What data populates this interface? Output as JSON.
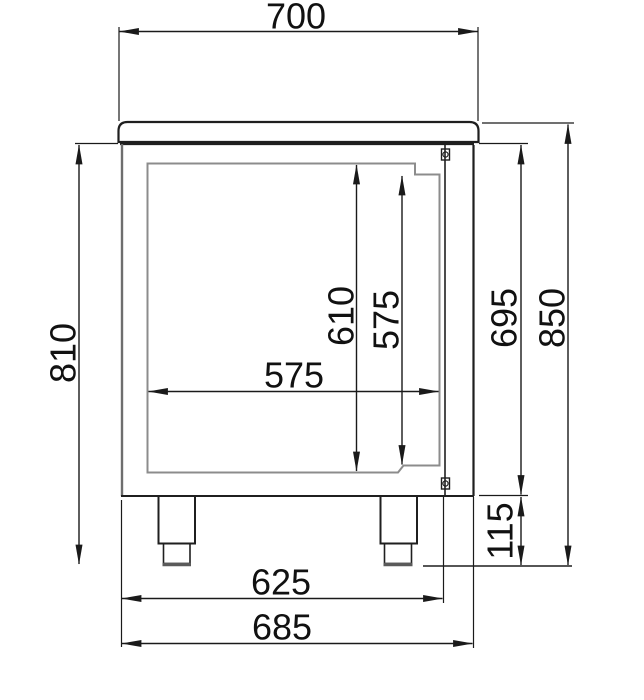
{
  "drawing": {
    "description": "Technical side-section drawing of a refrigerated counter cabinet with worktop, door and adjustable feet, annotated with dimensions",
    "colors": {
      "primary_line": "#1a1a1a",
      "secondary_line": "#8c8c8c",
      "background": "#ffffff"
    },
    "dimensions": {
      "countertop_depth": {
        "value": "700",
        "orientation": "horizontal",
        "position": "top"
      },
      "body_height": {
        "value": "810",
        "orientation": "vertical",
        "position": "left"
      },
      "interior_height": {
        "value": "610",
        "orientation": "vertical",
        "position": "inside"
      },
      "door_opening_height": {
        "value": "575",
        "orientation": "vertical",
        "position": "inside"
      },
      "interior_depth": {
        "value": "575",
        "orientation": "horizontal",
        "position": "inside"
      },
      "carcass_height": {
        "value": "695",
        "orientation": "vertical",
        "position": "right"
      },
      "overall_height": {
        "value": "850",
        "orientation": "vertical",
        "position": "right"
      },
      "foot_height": {
        "value": "115",
        "orientation": "vertical",
        "position": "right-bottom"
      },
      "body_depth": {
        "value": "625",
        "orientation": "horizontal",
        "position": "bottom"
      },
      "overall_depth_with_door": {
        "value": "685",
        "orientation": "horizontal",
        "position": "bottom"
      }
    }
  }
}
